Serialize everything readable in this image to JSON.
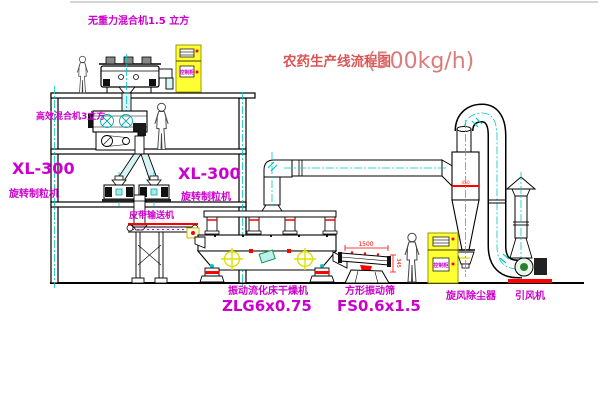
{
  "title": {
    "prefix": "农药生产线流程图",
    "capacity": "(500kg/h)"
  },
  "labels": {
    "mixer_top": "无重力混合机1.5 立方",
    "mixer_mid": "高效混合机3立方",
    "granulator_left_model": "XL-300",
    "granulator_left_name": "旋转制粒机",
    "granulator_mid_model": "XL-300",
    "granulator_mid_name": "旋转制粒机",
    "belt_conveyor": "皮带输送机",
    "dryer_name": "振动流化床干燥机",
    "dryer_model": "ZLG6x0.75",
    "sieve_name": "方形振动筛",
    "sieve_model": "FS0.6x1.5",
    "cyclone_name": "旋风除尘器",
    "fan_name": "引风机",
    "cabinet": "控制柜"
  },
  "dimensions": {
    "sieve_length": "1500",
    "sieve_height": "345",
    "cyclone_band": "450"
  },
  "colors": {
    "label_magenta": "#cc00cc",
    "title_red": "#d95555",
    "centerline_cyan": "#00c8c8",
    "cabinet_yellow": "#ffff33",
    "accent_red": "#ff0000",
    "target_yellow": "#e0e000"
  }
}
